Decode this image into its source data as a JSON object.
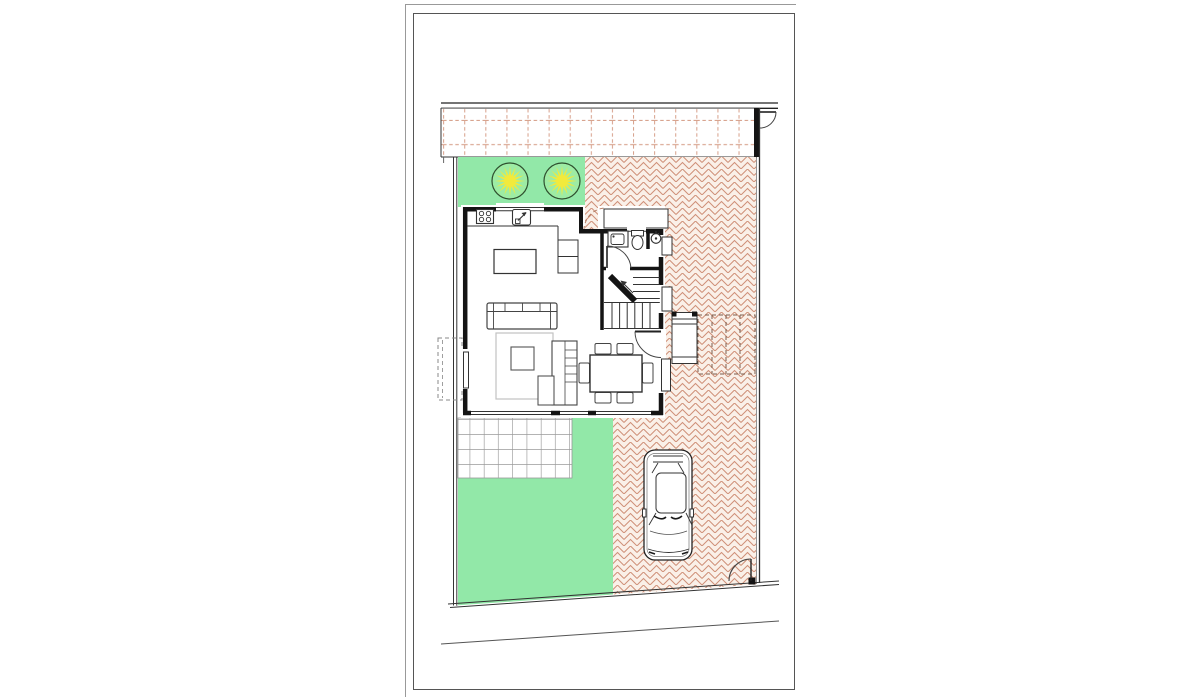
{
  "drawing": {
    "colors": {
      "paper": "#ffffff",
      "frame_outer": "#999999",
      "frame_inner": "#555555",
      "wall": "#141414",
      "line": "#333333",
      "street_line": "#222222",
      "lawn": "#92e8a8",
      "tree_fill": "#9deca4",
      "tree_outline": "#2e4f2e",
      "tree_star": "#f2ea3c",
      "paving_bg": "#faf0e8",
      "paving_stroke": "#cf9078",
      "sidewalk_stroke": "#d8a38e",
      "tick_stroke": "#666666",
      "grid_stroke": "#9a9a9a",
      "rug_stroke": "#c2c2c2",
      "furniture_stroke": "#444444",
      "dashed_steps": "#7a5c4c",
      "dashed_planter": "#888888",
      "door_arc": "#444444",
      "side_arc_dashed": "#b07a63"
    },
    "icons": {
      "tree": "circle-with-yellow-starburst",
      "car": "car-top-view",
      "door_swing": "quarter-circle-arc",
      "stove": "four-burner-cooktop",
      "kitchen_sink": "basin-with-faucet-arrow",
      "bath_sink": "square-basin",
      "toilet": "toilet-top-view",
      "shower": "shower-head-circle",
      "stairs": "staircase-with-up-arrow"
    }
  }
}
